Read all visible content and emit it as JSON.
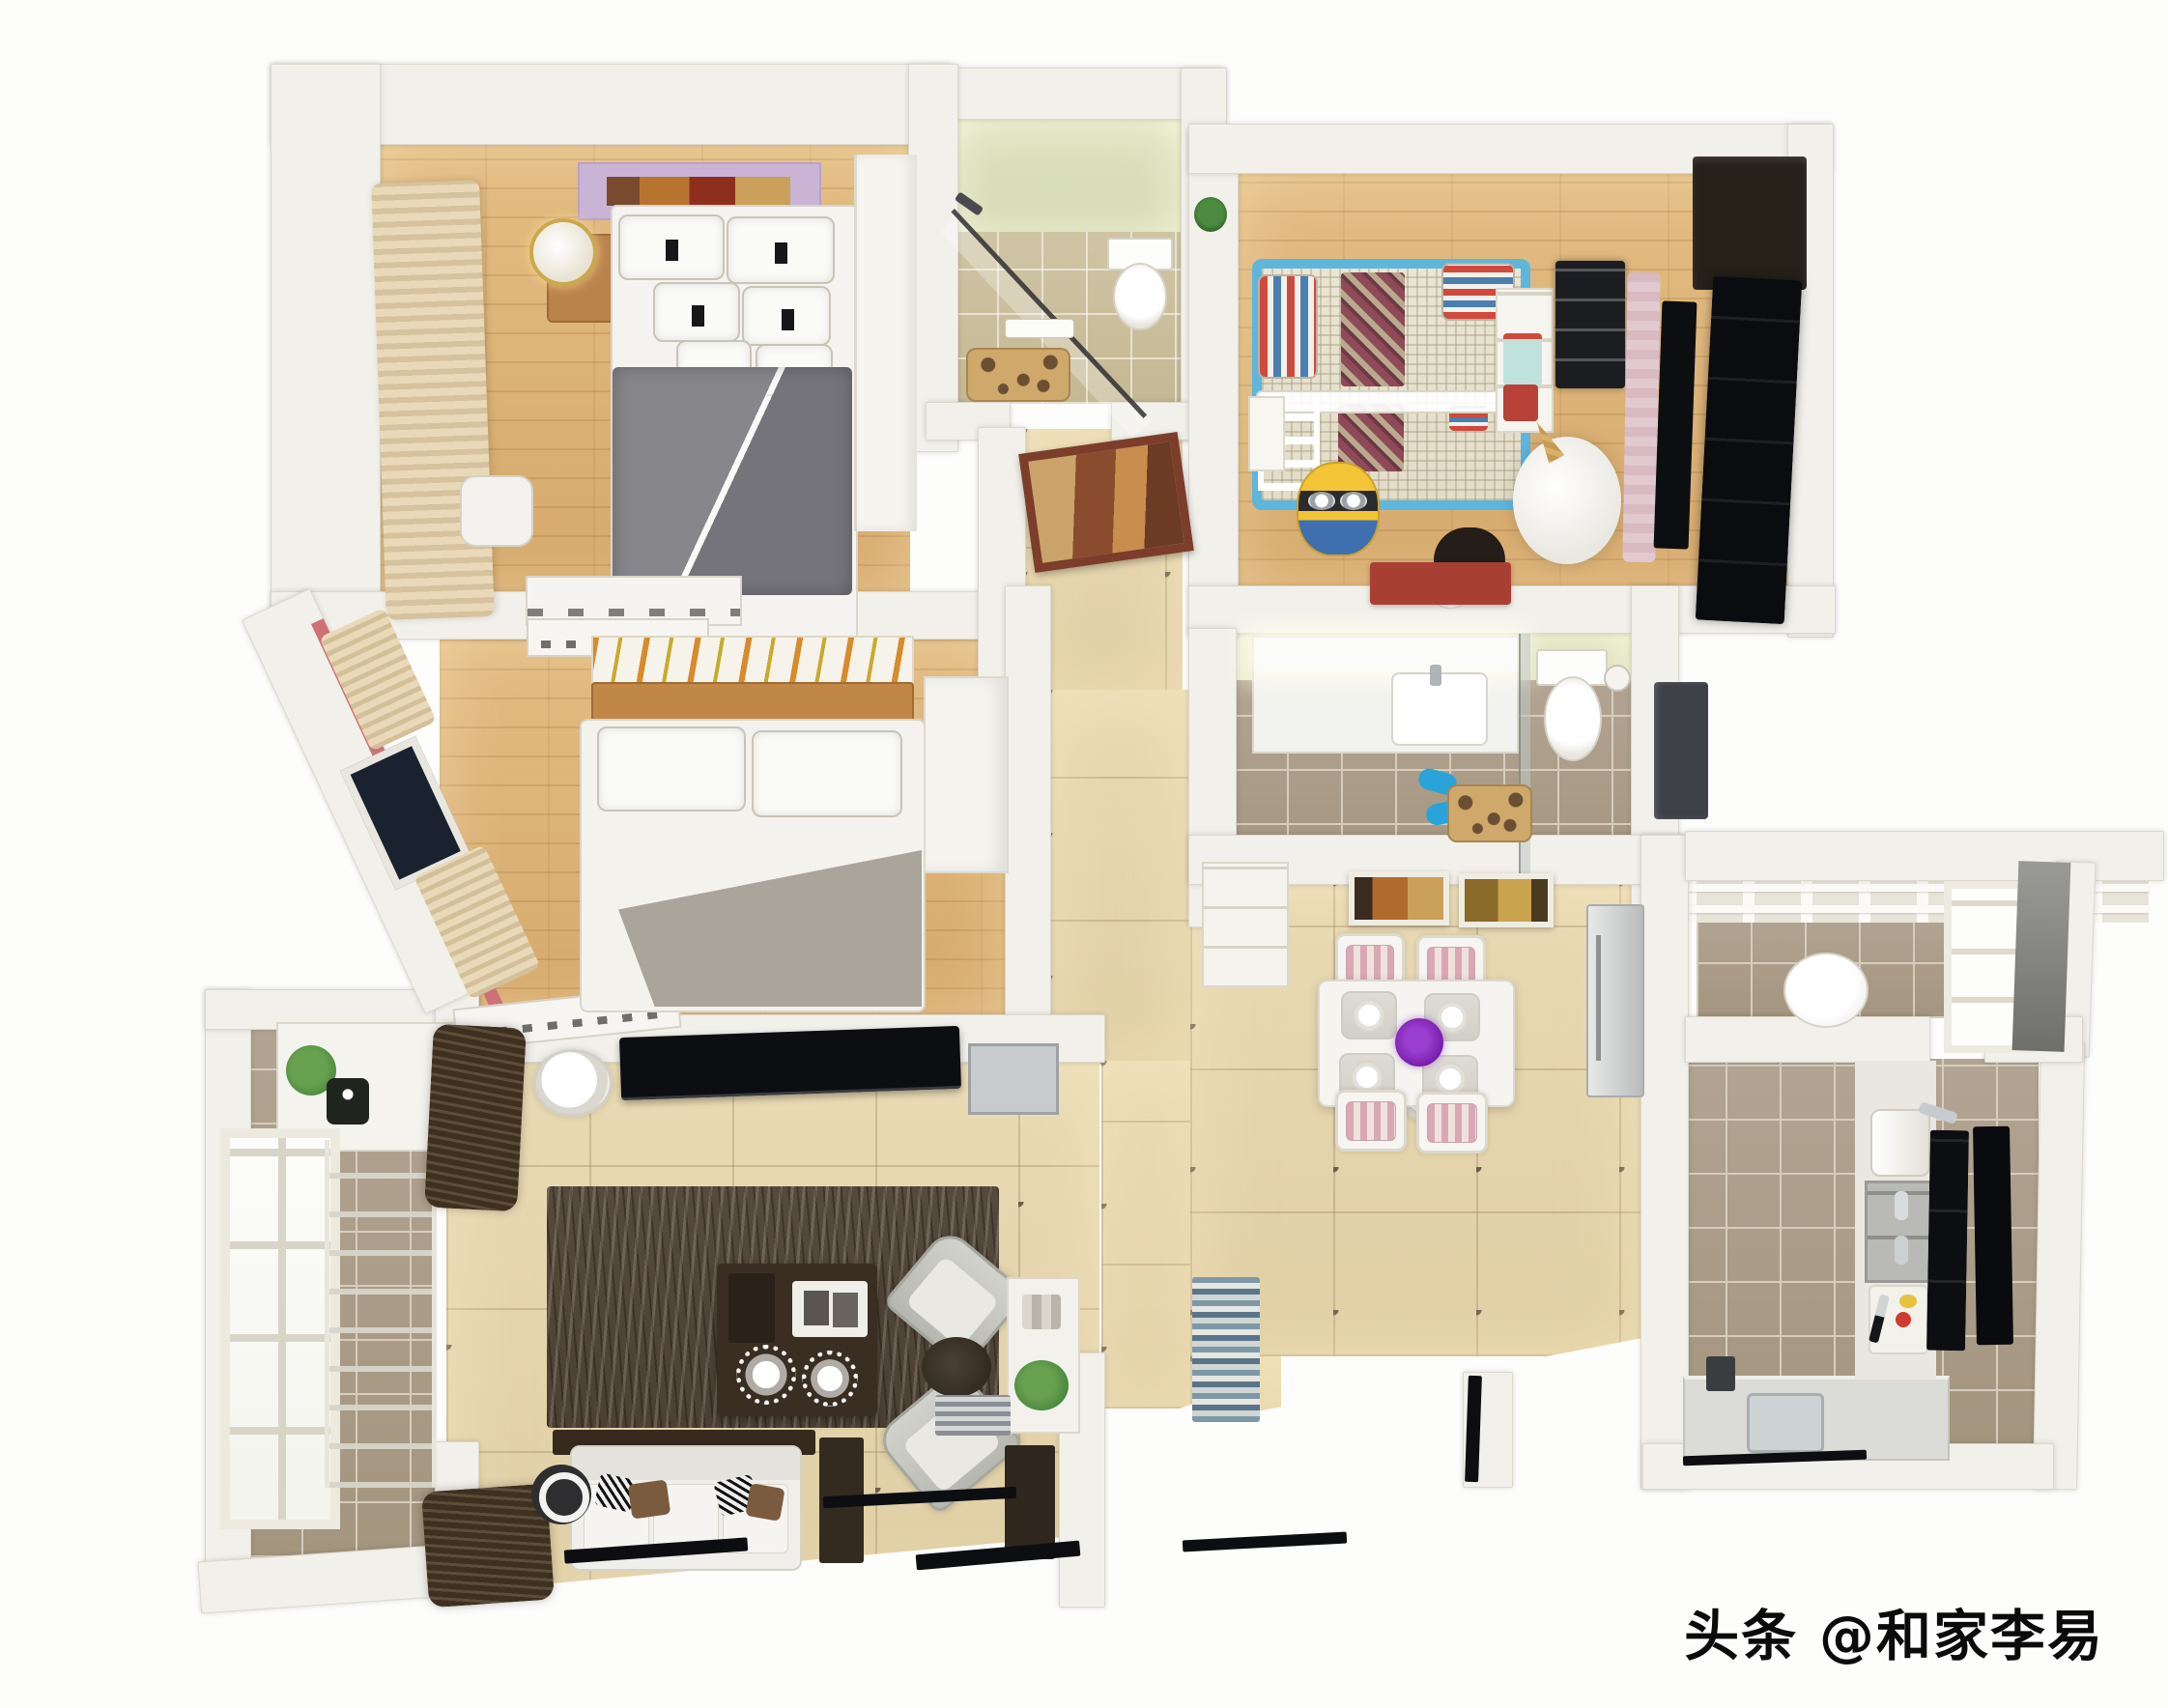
{
  "watermark": {
    "text": "头条 @和家李易"
  },
  "palette": {
    "wall": "#f2f0ea",
    "wallEdge": "#dcd8cd",
    "wood": "#e3bd84",
    "tileBeige": "#e9dab5",
    "diamond": "#6f5d49",
    "tileGray": "#b2a492",
    "tileGrayLine": "#d6cdbd",
    "bathTile": "#cfc4a4",
    "greenWall": "#e0e4c3",
    "rug": "#564a3d",
    "cream": "#ead9b8",
    "darkWood": "#3c2e20",
    "black": "#0d0e12",
    "blue": "#5fb6dc",
    "red": "#c2453a",
    "maroon": "#8e4a57",
    "yellow": "#f4c437",
    "purple": "#7d22b0",
    "teal": "#2aa3d8",
    "steel": "#c7cbce",
    "pinkCloth": "#e2c9d0",
    "lavender": "#c9b4d6",
    "counter": "#dbdbd7",
    "giraffeBase": "#cfa96b",
    "giraffeSpot": "#6b4f33",
    "bedWood": "#c08746",
    "sofaWhite": "#efeeea",
    "blanketGray": "#83838a",
    "pinkStripe": "#cc7277",
    "green": "#4c8a40"
  },
  "scene": {
    "type": "3d-floorplan-top-view",
    "rooms": [
      {
        "id": "master-bedroom",
        "floor": "wood",
        "furniture": [
          "double-bed-gray-blanket",
          "wall-art-banner",
          "nightstand",
          "gold-lamp",
          "cream-curtains",
          "wardrobe",
          "desk",
          "chair"
        ]
      },
      {
        "id": "bathroom-main",
        "floor": "beige-tile",
        "walls": "light-green",
        "furniture": [
          "glass-shower",
          "toilet",
          "towel",
          "giraffe-mat",
          "plant"
        ]
      },
      {
        "id": "entry-hall",
        "floor": "beige-tile-diamond",
        "furniture": [
          "framed-painting"
        ]
      },
      {
        "id": "kids-room",
        "floor": "wood",
        "furniture": [
          "blue-bunk-bed",
          "striped-pillows",
          "ladder",
          "black-dresser",
          "shelf-baskets",
          "minion-toy",
          "unicorn-plush",
          "panda-plush",
          "red-bench",
          "clothes-rail",
          "black-tv-panel"
        ]
      },
      {
        "id": "bathroom-second",
        "floor": "gray-tile",
        "furniture": [
          "vanity-sink",
          "mirror-lights",
          "glass-divider",
          "toilet",
          "blue-slippers",
          "giraffe-mat",
          "utility-cabinet"
        ]
      },
      {
        "id": "bedroom-second",
        "floor": "wood",
        "furniture": [
          "double-bed-wood-headboard",
          "art-banner",
          "curtained-windows",
          "radiators",
          "wardrobe"
        ]
      },
      {
        "id": "laundry-balcony",
        "floor": "gray-tile",
        "furniture": [
          "cabinet",
          "plant",
          "window",
          "drying-rack"
        ]
      },
      {
        "id": "living-room",
        "floor": "beige-tile-diamond",
        "furniture": [
          "tv-console",
          "speaker-discs",
          "zebra-rug",
          "coffee-table",
          "sofa",
          "armchairs",
          "side-tables",
          "console-plant",
          "brown-curtains"
        ]
      },
      {
        "id": "dining-room",
        "floor": "beige-tile-diamond",
        "furniture": [
          "dining-table",
          "four-chairs",
          "purple-flowers",
          "place-settings",
          "two-pictures",
          "sideboard",
          "fridge"
        ]
      },
      {
        "id": "kitchen",
        "floor": "gray-tile",
        "furniture": [
          "counter-sink",
          "faucet",
          "shelf-rack",
          "paper-holder",
          "cutting-board-knife",
          "black-panels"
        ]
      },
      {
        "id": "service-balcony",
        "floor": "gray-tile",
        "furniture": [
          "pergola-roof",
          "window",
          "stool"
        ]
      }
    ]
  }
}
